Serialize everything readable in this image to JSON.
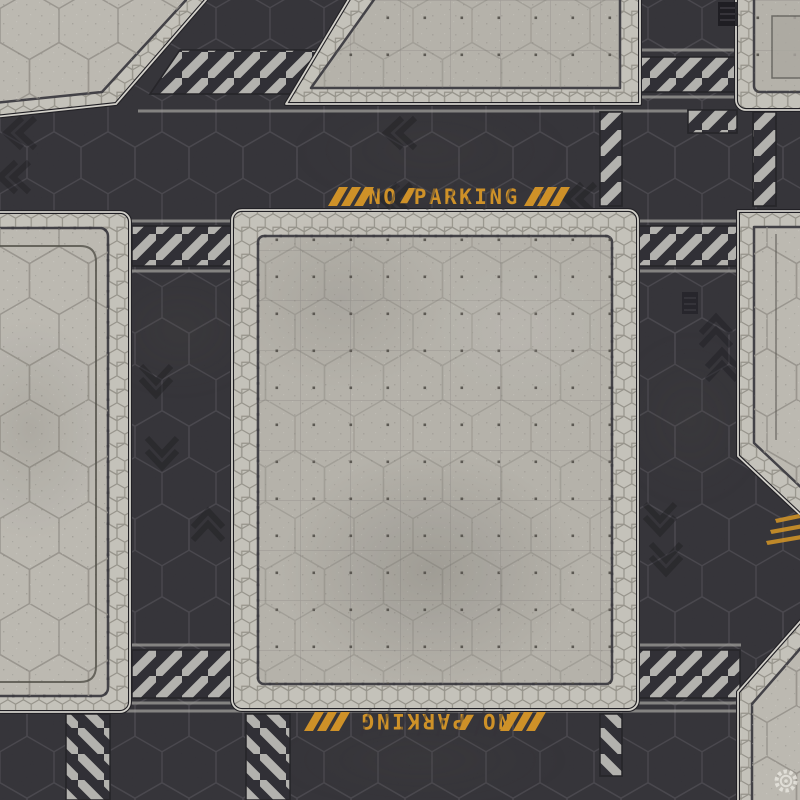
{
  "signs": {
    "top": {
      "text": "NO PARKING",
      "orientation_deg": 0
    },
    "bottom": {
      "text": "NO PARKING",
      "orientation_deg": 180
    }
  },
  "logo": {
    "name": "gear emblem watermark"
  },
  "palette": {
    "road": "#2d2c32",
    "road_hex_line": "#5a5862",
    "concrete": "#b4b1a9",
    "concrete_tile": "#bcb9b1",
    "cobble_border": "#c5c2ba",
    "trim_light": "#d4d2cb",
    "seam_dark": "#3b3a40",
    "hazard_base": "#28272d",
    "hazard_stripe": "#b2b1ad",
    "marking_line": "#9e9d99",
    "accent_orange": "#cf8e1e",
    "chevron": "#15141a"
  }
}
